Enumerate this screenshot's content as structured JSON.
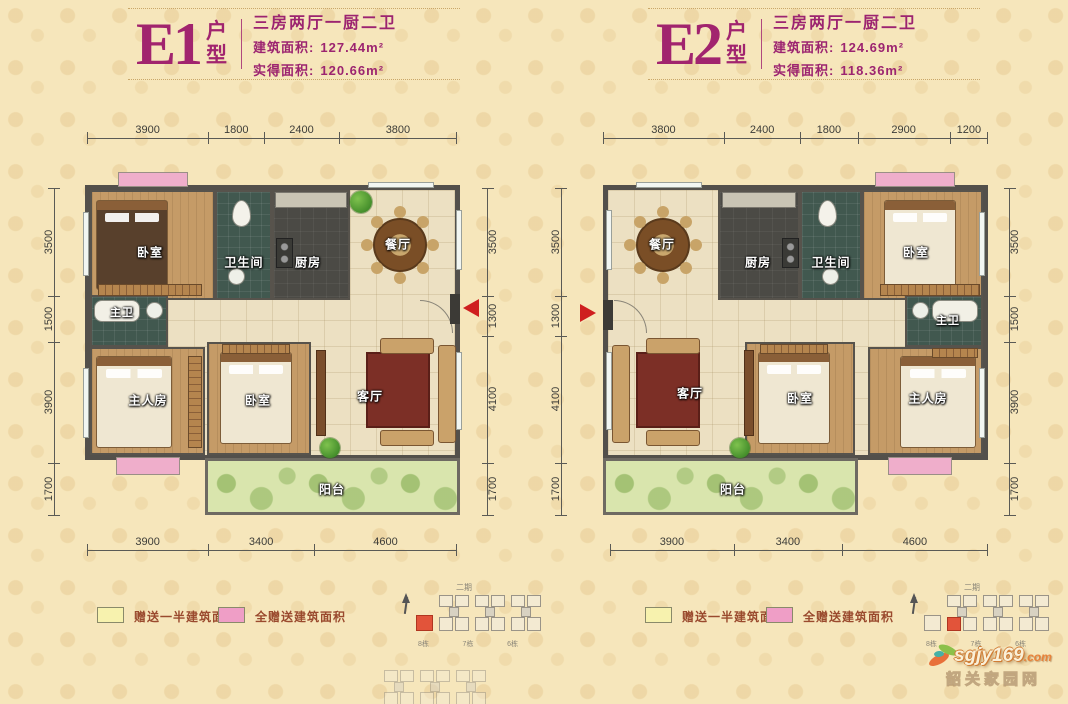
{
  "watermark": {
    "brand": "sgjy169",
    "tld": ".com",
    "site": "韶关家园网"
  },
  "legend": {
    "half": "赠送一半建筑面积",
    "full": "全赠送建筑面积"
  },
  "keyplan": {
    "phase": "二期",
    "buildings": [
      "8栋",
      "7栋",
      "6栋"
    ]
  },
  "units": [
    {
      "code": "E1",
      "type_suffix": "户型",
      "layout": "三房两厅一厨二卫",
      "build_area_label": "建筑面积:",
      "build_area": "127.44m²",
      "net_area_label": "实得面积:",
      "net_area": "120.66m²",
      "dims_top": [
        "3900",
        "1800",
        "2400",
        "3800"
      ],
      "dims_bottom": [
        "3900",
        "3400",
        "4600"
      ],
      "dims_left": [
        "3500",
        "1500",
        "3900",
        "1700"
      ],
      "dims_right": [
        "3500",
        "1300",
        "4100",
        "1700"
      ],
      "rooms": {
        "bedroom": "卧室",
        "bathroom": "卫生间",
        "kitchen": "厨房",
        "dining": "餐厅",
        "master_bath": "主卫",
        "master": "主人房",
        "bedroom2": "卧室",
        "living": "客厅",
        "balcony": "阳台"
      }
    },
    {
      "code": "E2",
      "type_suffix": "户型",
      "layout": "三房两厅一厨二卫",
      "build_area_label": "建筑面积:",
      "build_area": "124.69m²",
      "net_area_label": "实得面积:",
      "net_area": "118.36m²",
      "dims_top": [
        "3800",
        "2400",
        "1800",
        "2900",
        "1200"
      ],
      "dims_bottom": [
        "3900",
        "3400",
        "4600"
      ],
      "dims_left": [
        "3500",
        "1300",
        "4100",
        "1700"
      ],
      "dims_right": [
        "3500",
        "1500",
        "3900",
        "1700"
      ],
      "rooms": {
        "bedroom": "卧室",
        "bathroom": "卫生间",
        "kitchen": "厨房",
        "dining": "餐厅",
        "master_bath": "主卫",
        "master": "主人房",
        "bedroom2": "卧室",
        "living": "客厅",
        "balcony": "阳台"
      }
    }
  ]
}
